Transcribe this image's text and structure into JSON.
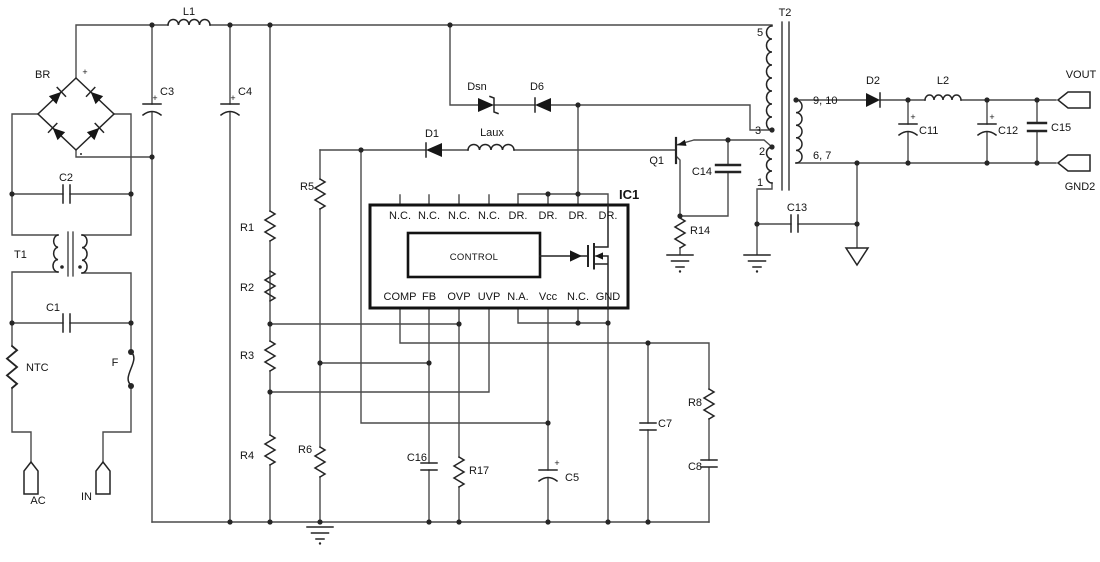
{
  "schematic": {
    "labels": {
      "br": "BR",
      "plus": "+",
      "l1": "L1",
      "c3": "C3",
      "c4": "C4",
      "c2": "C2",
      "t1": "T1",
      "c1": "C1",
      "ntc": "NTC",
      "f": "F",
      "ac": "AC",
      "in": "IN",
      "r1": "R1",
      "r2": "R2",
      "r3": "R3",
      "r4": "R4",
      "r5": "R5",
      "r6": "R6",
      "dsn": "Dsn",
      "d6": "D6",
      "d1": "D1",
      "laux": "Laux",
      "c16": "C16",
      "r17": "R17",
      "c5": "C5",
      "c7": "C7",
      "r8": "R8",
      "c8": "C8",
      "q1": "Q1",
      "c14": "C14",
      "r14": "R14",
      "c13": "C13",
      "t2": "T2",
      "d2": "D2",
      "l2": "L2",
      "c11": "C11",
      "c12": "C12",
      "c15": "C15",
      "vout": "VOUT",
      "gnd2": "GND2"
    },
    "ic1": {
      "name": "IC1",
      "control": "CONTROL",
      "top_pins": [
        "N.C.",
        "N.C.",
        "N.C.",
        "N.C.",
        "DR.",
        "DR.",
        "DR.",
        "DR."
      ],
      "bottom_pins": [
        "COMP",
        "FB",
        "OVP",
        "UVP",
        "N.A.",
        "Vcc",
        "N.C.",
        "GND"
      ]
    },
    "t2_pins": {
      "p5": "5",
      "p3": "3",
      "p2": "2",
      "p1": "1",
      "p910": "9, 10",
      "p67": "6, 7"
    }
  }
}
